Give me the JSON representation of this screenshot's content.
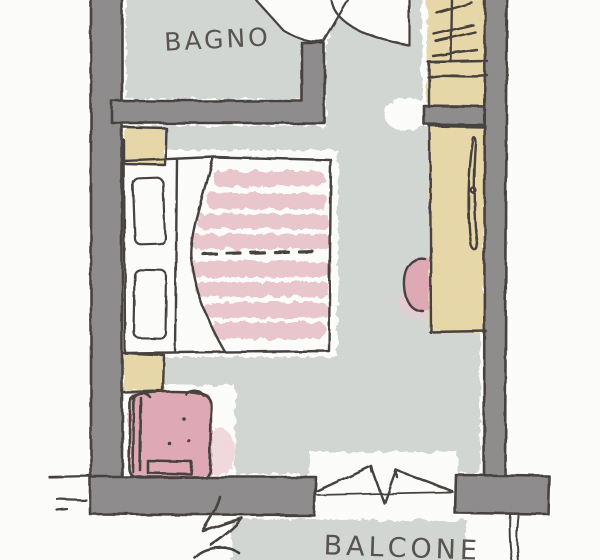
{
  "labels": {
    "bathroom": "BAGNO",
    "balcony": "BALCONE"
  },
  "legend": [
    "double-bed",
    "pillows",
    "striped-blanket",
    "nightstands",
    "closet-with-hangers",
    "wardrobe",
    "pouf",
    "armchair",
    "entry-door-swing",
    "bathroom-door-swing",
    "balcony-french-door",
    "balcony-railing"
  ],
  "colors": {
    "paper": "#fdfdfc",
    "floor_wash": "#d2d7d3",
    "wall_fill": "#8e8b8c",
    "ink": "#45413e",
    "furniture_tan": "#e8d8a8",
    "pink": "#dfa9b4",
    "pink_light": "#eccad2",
    "blanket_stripe": "#eac7cd",
    "label_ink": "#56524f"
  }
}
